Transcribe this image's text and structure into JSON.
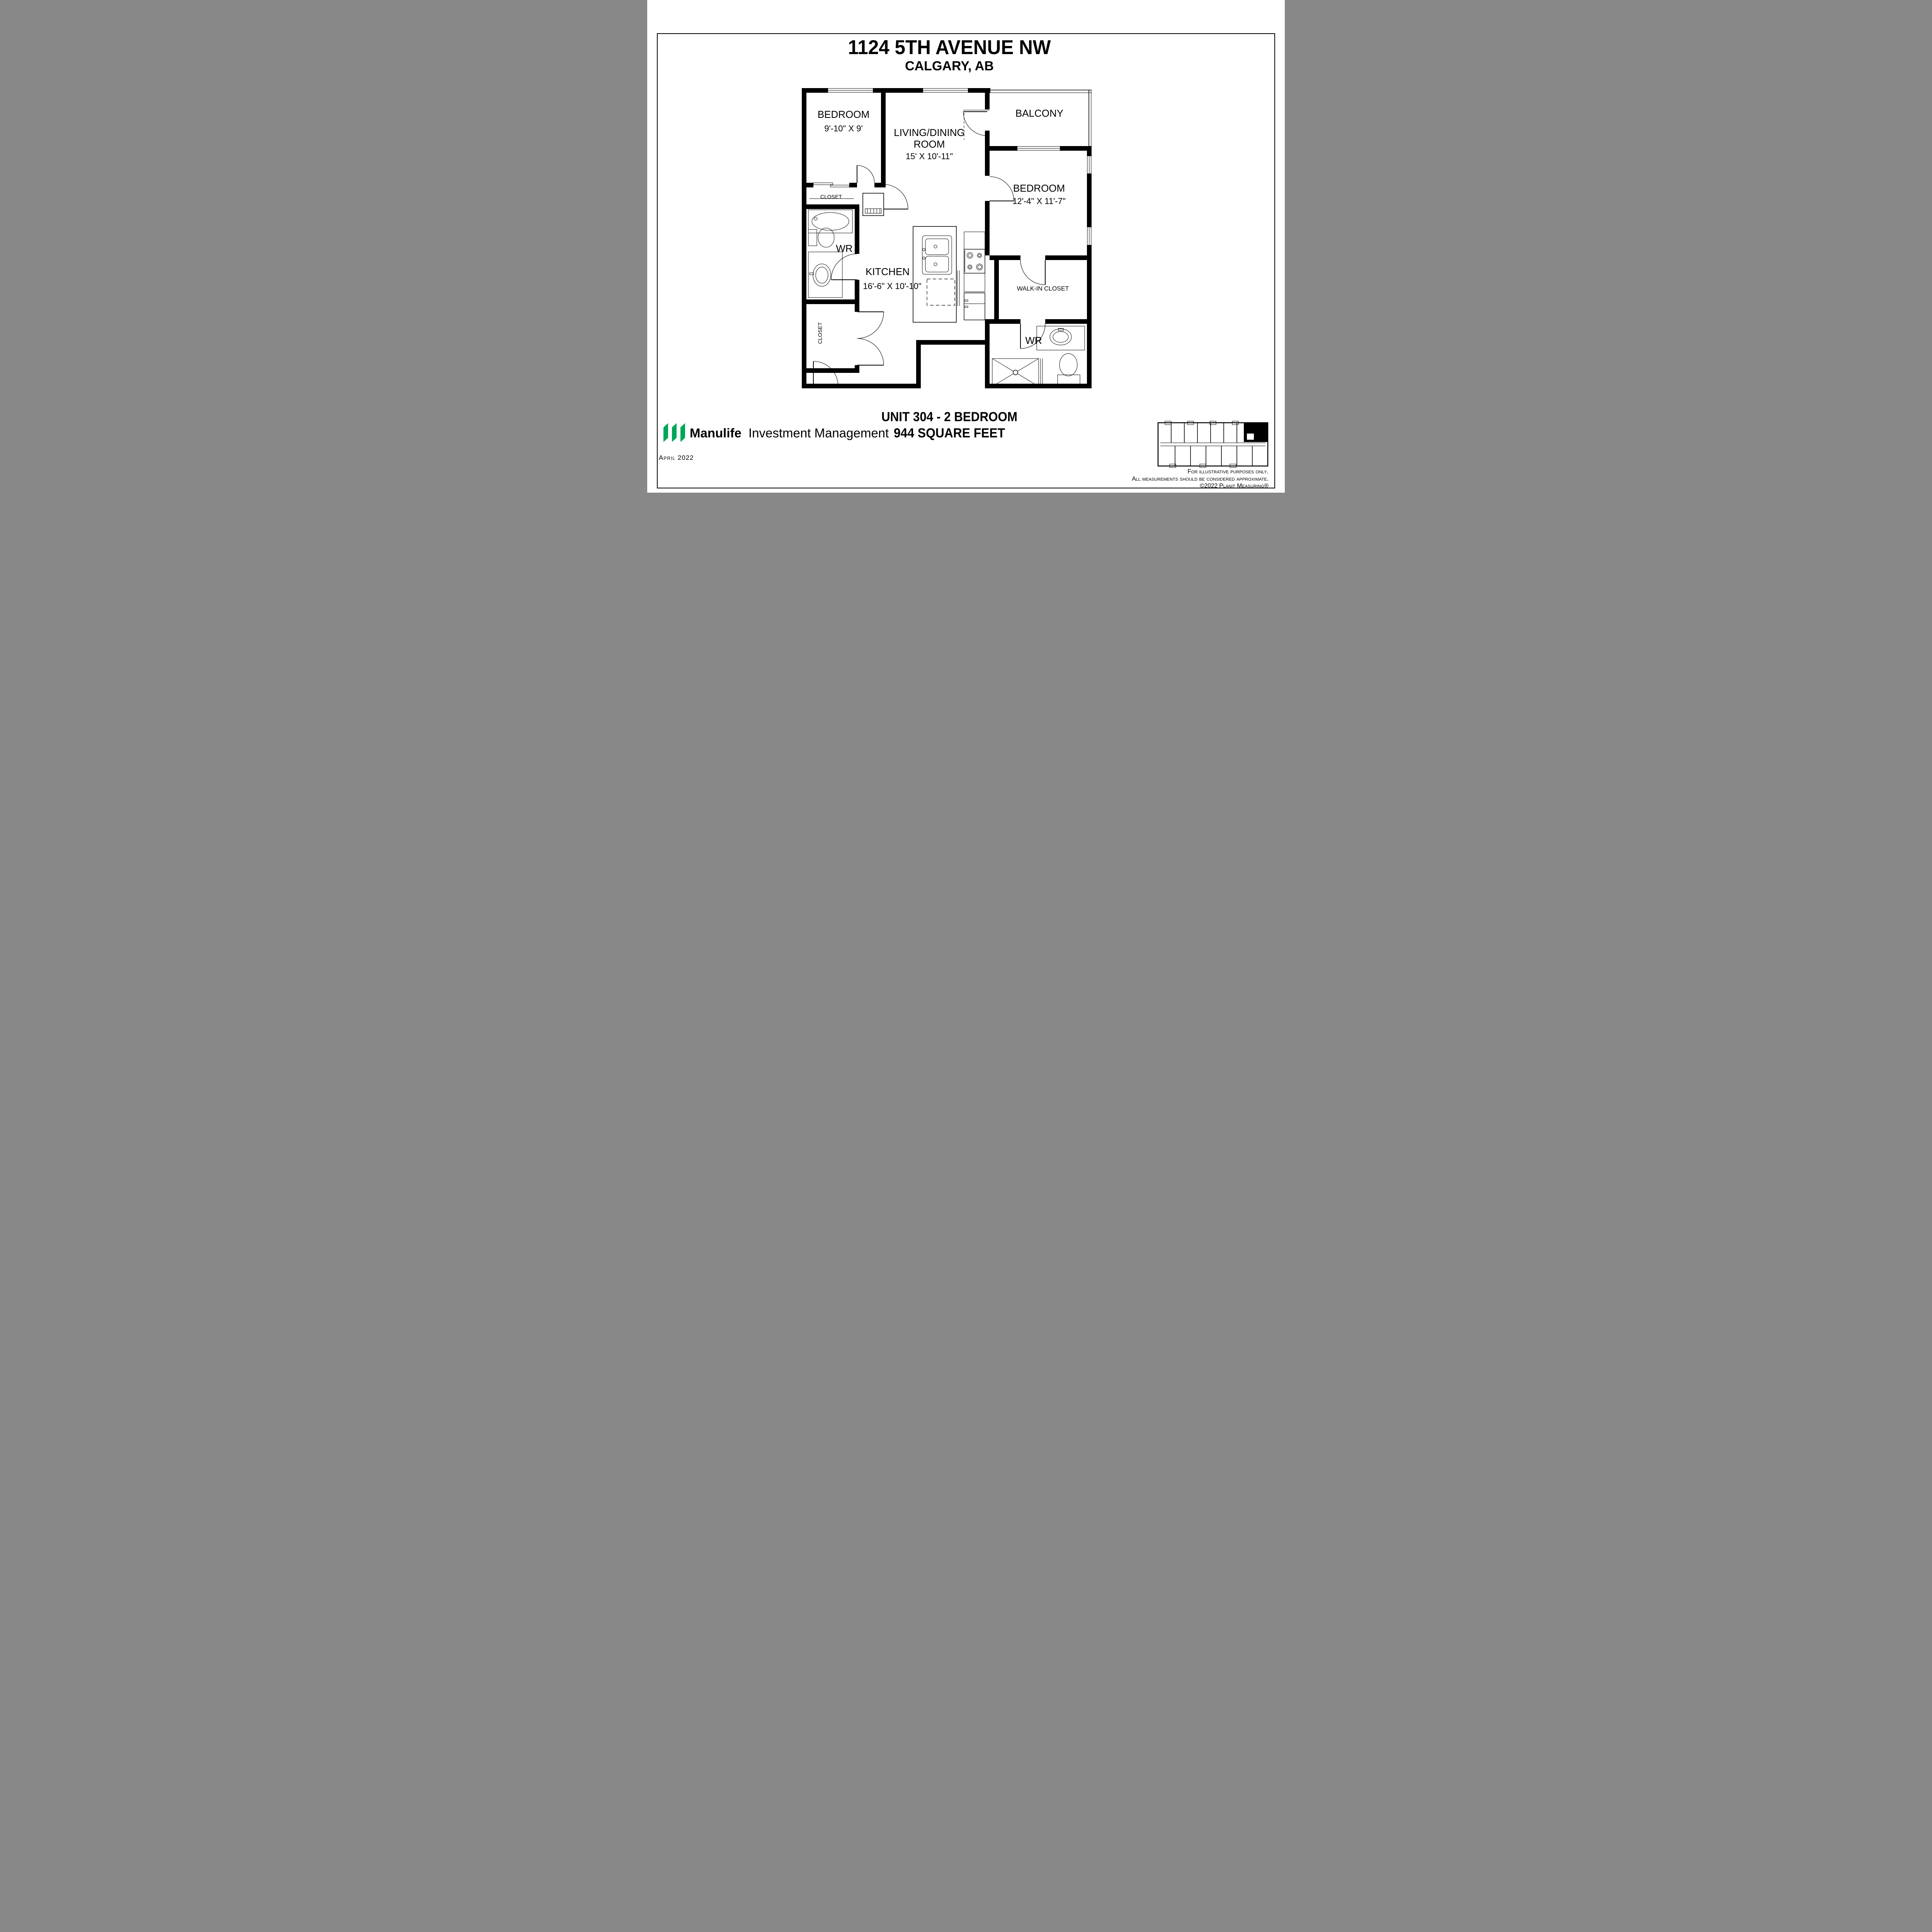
{
  "page": {
    "title": "1124 5TH AVENUE NW",
    "subtitle": "CALGARY, AB",
    "unit_title": "UNIT 304 - 2 BEDROOM",
    "unit_area": "944 SQUARE FEET",
    "date": "April 2022",
    "disclaimer_line1": "For illustrative purposes only.",
    "disclaimer_line2": "All measurements should be considered approximate.",
    "disclaimer_line3": "©2022 Planit Measuring®",
    "brand": {
      "name": "Manulife",
      "division": "Investment Management",
      "green": "#00a758"
    }
  },
  "floor_plan": {
    "rooms": {
      "bedroom_1": {
        "label": "BEDROOM",
        "dims": "9'-10\" X 9'"
      },
      "living_dining": {
        "line1": "LIVING/DINING",
        "line2": "ROOM",
        "dims": "15' X 10'-11\""
      },
      "balcony": {
        "label": "BALCONY"
      },
      "bedroom_2": {
        "label": "BEDROOM",
        "dims": "12'-4\" X 11'-7\""
      },
      "kitchen": {
        "label": "KITCHEN",
        "dims": "16'-6\" X 10'-10\""
      },
      "washroom_main": {
        "label": "WR"
      },
      "washroom_ensuite": {
        "label": "WR"
      },
      "walk_in_closet": {
        "label": "WALK-IN CLOSET"
      },
      "closet_bedroom_1": {
        "label": "CLOSET"
      },
      "closet_entry": {
        "label": "CLOSET"
      }
    }
  }
}
